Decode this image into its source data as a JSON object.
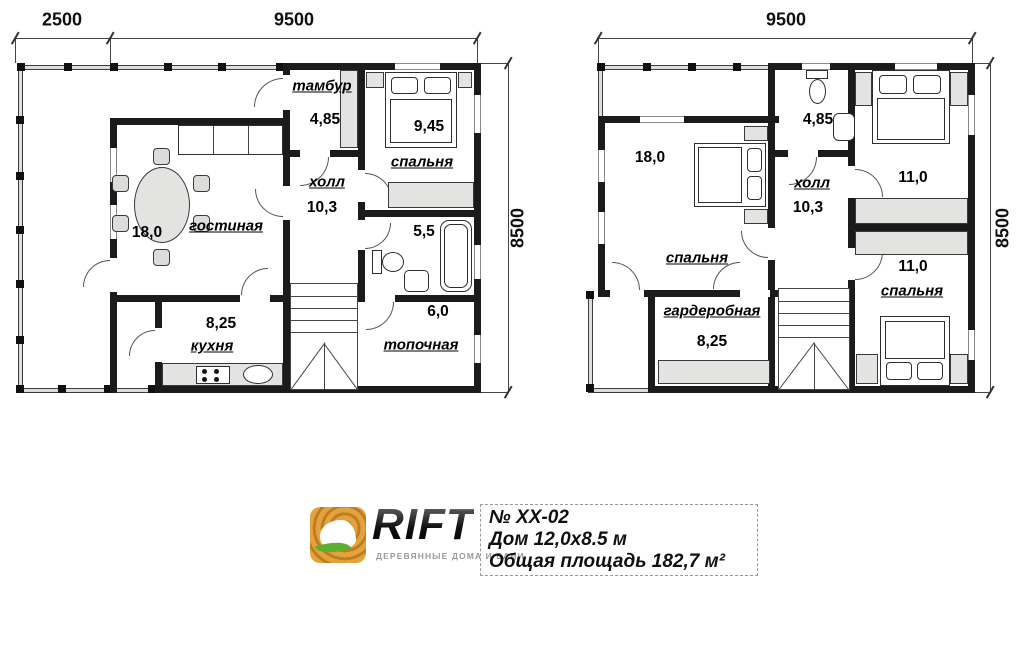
{
  "logo": {
    "name": "RIFT",
    "tagline": "ДЕРЕВЯННЫЕ ДОМА И БАНИ"
  },
  "title_block": {
    "project_no": "№ ХХ-02",
    "house_size": "Дом 12,0х8.5 м",
    "total_area": "Общая площадь 182,7 м²"
  },
  "floor1": {
    "dim_terrace": "2500",
    "dim_width": "9500",
    "dim_height": "8500",
    "tambur": {
      "name": "тамбур",
      "area": "4,85"
    },
    "bedroom": {
      "name": "спальня",
      "area": "9,45"
    },
    "hall": {
      "name": "холл",
      "area": "10,3"
    },
    "living": {
      "name": "гостиная",
      "area": "18,0"
    },
    "bath": {
      "area": "5,5"
    },
    "kitchen": {
      "name": "кухня",
      "area": "8,25"
    },
    "boiler": {
      "name": "топочная",
      "area": "6,0"
    }
  },
  "floor2": {
    "dim_width": "9500",
    "dim_height": "8500",
    "bedroom_big": {
      "name": "спальня",
      "area": "18,0"
    },
    "bath": {
      "area": "4,85"
    },
    "hall": {
      "name": "холл",
      "area": "10,3"
    },
    "bedroom_top": {
      "area": "11,0"
    },
    "bedroom_bottom": {
      "name": "спальня",
      "area": "11,0"
    },
    "wardrobe": {
      "name": "гардеробная",
      "area": "8,25"
    }
  },
  "colors": {
    "wall": "#1b1b1b",
    "furniture": "#e3e3e1",
    "wood": "#d0882f",
    "leaf": "#5fae2f"
  }
}
